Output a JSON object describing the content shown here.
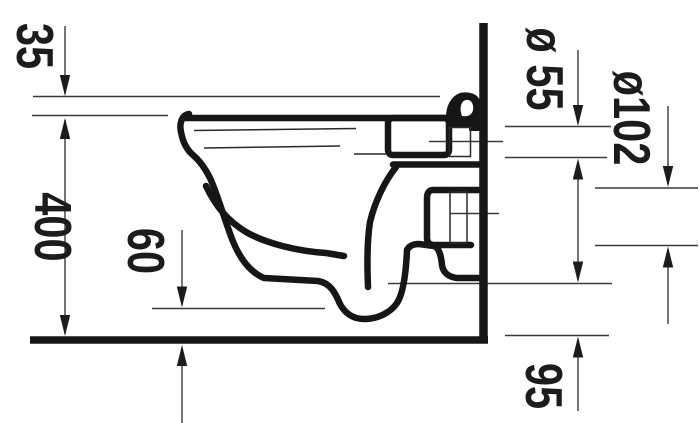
{
  "drawing": {
    "labels": {
      "dim_35": "35",
      "dim_400": "400",
      "dim_60": "60",
      "dim_dia55": "ø 55",
      "dim_dia102": "ø102",
      "dim_95": "95"
    },
    "colors": {
      "body_line": "#161616",
      "dimension_line": "#3a3a3a",
      "background": "#ffffff"
    }
  }
}
